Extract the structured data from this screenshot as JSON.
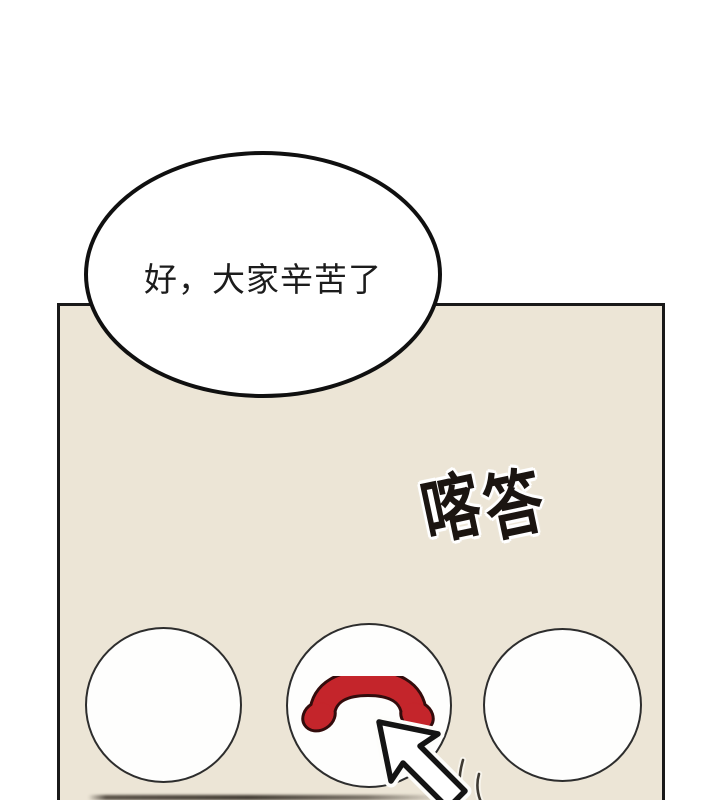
{
  "comic": {
    "bubble": {
      "text": "好，大家辛苦了"
    },
    "sfx": {
      "chars": [
        "喀",
        "答"
      ]
    },
    "buttons": {
      "count": 3,
      "middle_icon": "hang-up-phone-icon"
    },
    "pointer": "cursor-arrow-icon"
  },
  "colors": {
    "page_background": "#ffffff",
    "panel_background": "#ece5d6",
    "line_ink": "#191919",
    "phone_red": "#c4252b",
    "phone_outline": "#330c0c",
    "circle_fill": "#fefefd"
  }
}
